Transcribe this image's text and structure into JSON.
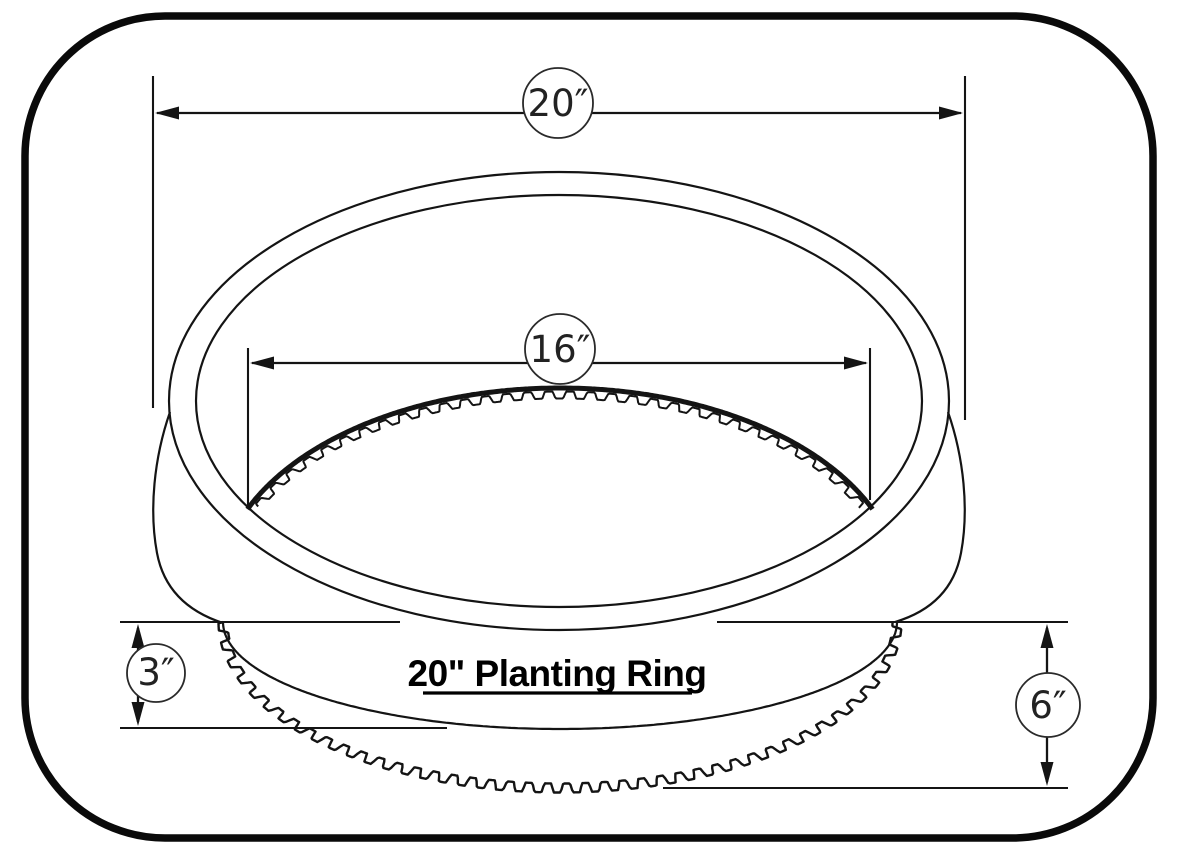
{
  "title": {
    "text": "20\" Planting Ring"
  },
  "dimensions": {
    "outer_diameter": {
      "label": "20″",
      "value": "20 in"
    },
    "inner_diameter": {
      "label": "16″",
      "value": "16 in"
    },
    "upper_height": {
      "label": "3″",
      "value": "3 in"
    },
    "total_height": {
      "label": "6″",
      "value": "6 in"
    }
  },
  "colors": {
    "line": "#141414",
    "background": "#ffffff"
  }
}
